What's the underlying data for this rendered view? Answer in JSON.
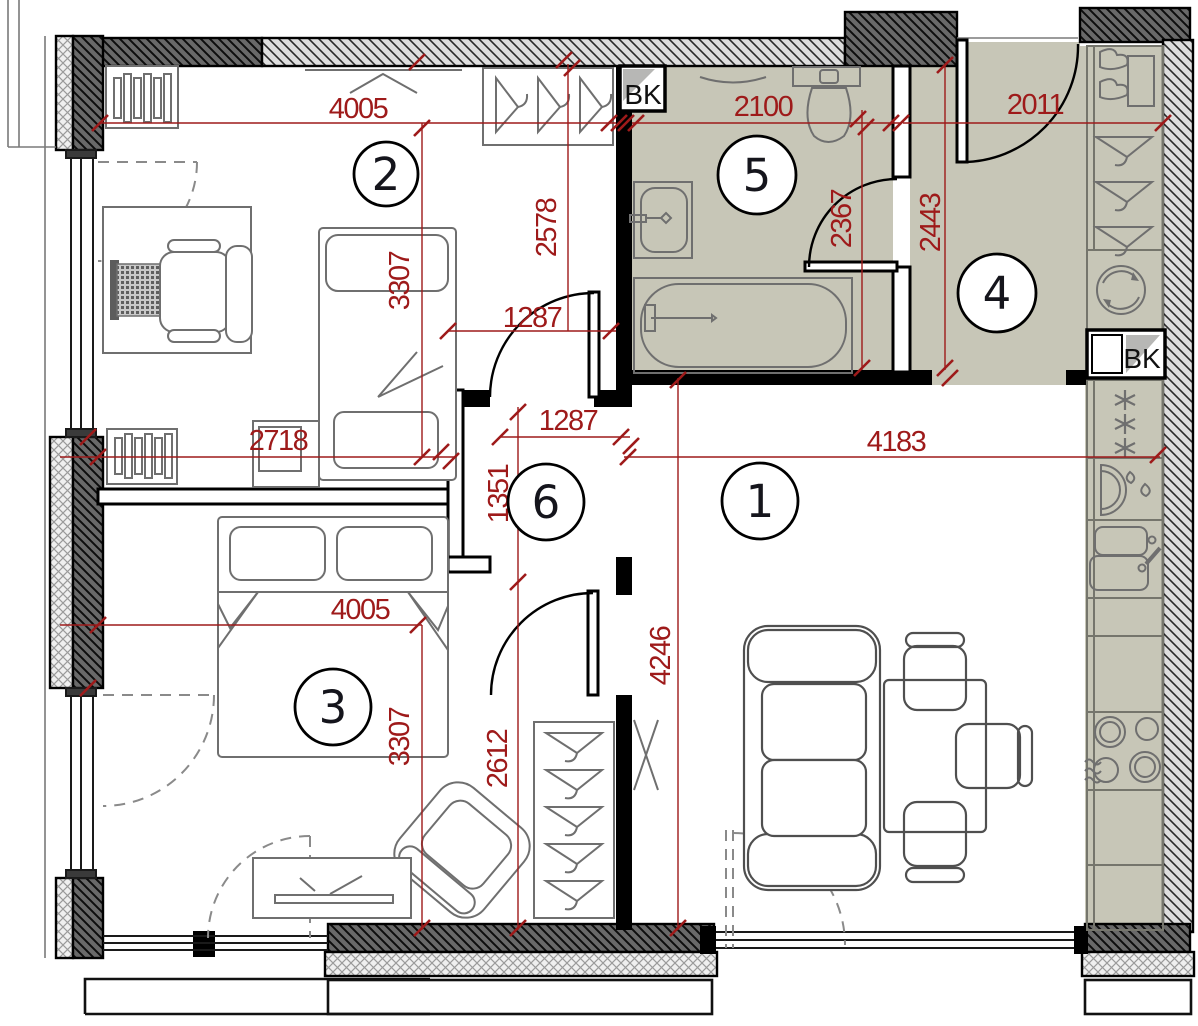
{
  "drawing": {
    "kind": "apartment floor plan",
    "accent_color": "#9e1a1a",
    "room_fill_color": "#c7c6b7",
    "wall_hatch_color": "#696969"
  },
  "rooms": {
    "r1": "1",
    "r2": "2",
    "r3": "3",
    "r4": "4",
    "r5": "5",
    "r6": "6"
  },
  "dimensions": {
    "room2_width": "4005",
    "room2_height": "3307",
    "room2_bottom_width": "2718",
    "room2_closet_depth": "2578",
    "hall_opening_a": "1287",
    "hall_opening_b": "1287",
    "bathroom_width": "2100",
    "bathroom_height": "2367",
    "entry_hall_width": "2011",
    "entry_hall_height": "2443",
    "living_width": "4183",
    "living_height": "4246",
    "hall_upper_length": "1351",
    "hall_lower_length": "2612",
    "room3_width": "4005",
    "room3_height": "3307"
  },
  "labels": {
    "bk_bathroom": "BK",
    "bk_kitchen": "BK"
  }
}
